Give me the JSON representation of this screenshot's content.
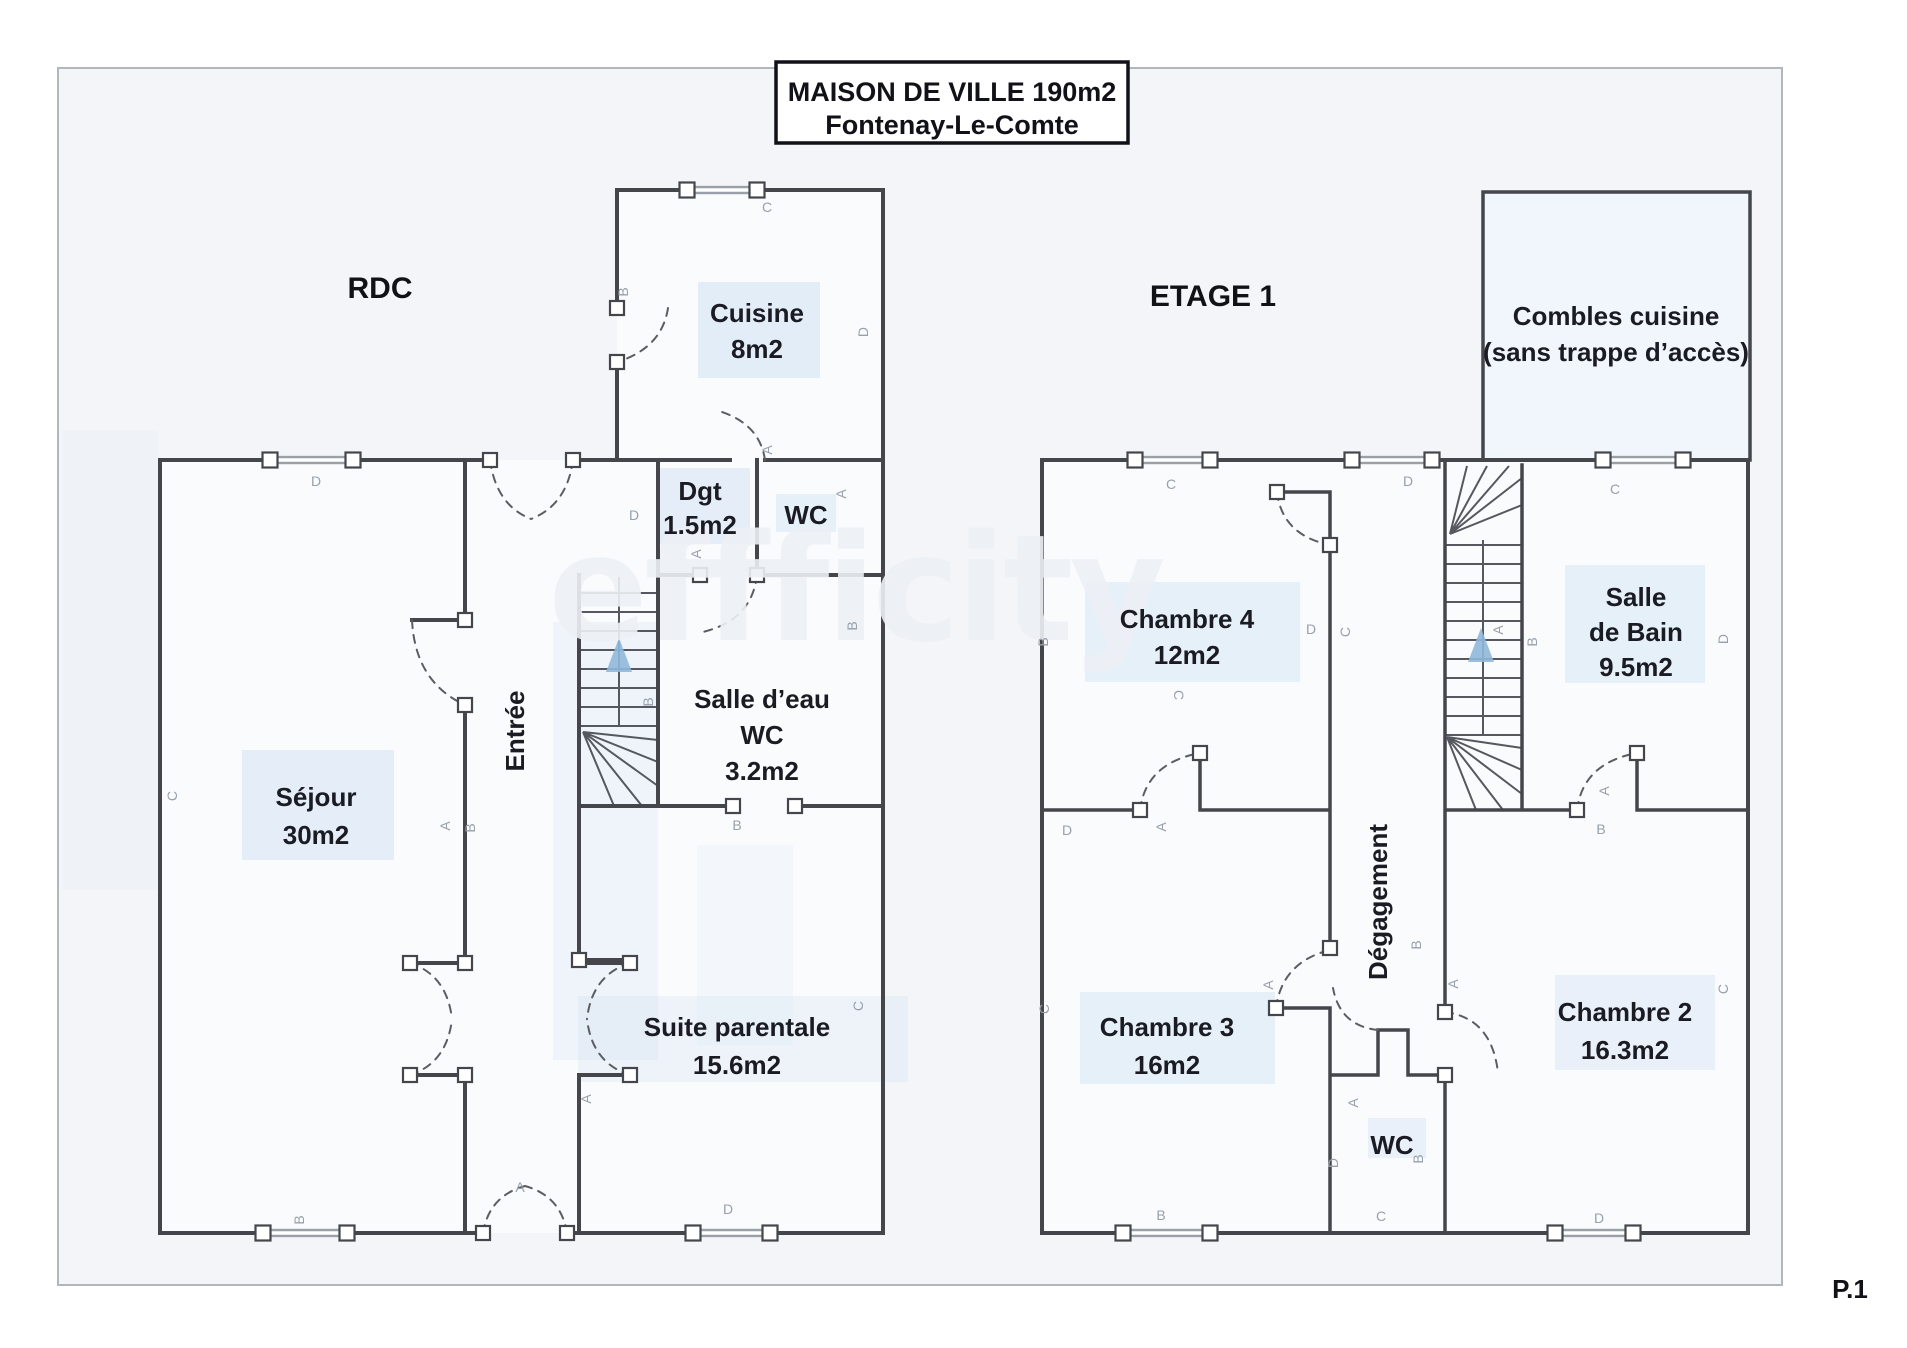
{
  "title": {
    "line1": "MAISON DE VILLE 190m2",
    "line2": "Fontenay-Le-Comte"
  },
  "watermark": "effficity",
  "page": {
    "label": "P.1"
  },
  "floors": [
    {
      "id": "rdc",
      "label": "RDC"
    },
    {
      "id": "etage1",
      "label": "ETAGE 1"
    }
  ],
  "rooms": [
    {
      "id": "cuisine",
      "floor": "rdc",
      "lines": [
        "Cuisine",
        "8m2"
      ],
      "x": 757,
      "y": 322,
      "lh": 36
    },
    {
      "id": "dgt",
      "floor": "rdc",
      "lines": [
        "Dgt",
        "1.5m2"
      ],
      "x": 700,
      "y": 500,
      "lh": 34
    },
    {
      "id": "wc-rdc",
      "floor": "rdc",
      "lines": [
        "WC"
      ],
      "x": 806,
      "y": 524,
      "lh": 34
    },
    {
      "id": "salle-deau",
      "floor": "rdc",
      "lines": [
        "Salle d’eau",
        "WC",
        "3.2m2"
      ],
      "x": 762,
      "y": 708,
      "lh": 36
    },
    {
      "id": "entree",
      "floor": "rdc",
      "lines": [
        "Entrée"
      ],
      "x": 524,
      "y": 731,
      "lh": 0,
      "vertical": true
    },
    {
      "id": "sejour",
      "floor": "rdc",
      "lines": [
        "Séjour",
        "30m2"
      ],
      "x": 316,
      "y": 806,
      "lh": 38
    },
    {
      "id": "suite-parentale",
      "floor": "rdc",
      "lines": [
        "Suite parentale",
        "15.6m2"
      ],
      "x": 737,
      "y": 1036,
      "lh": 38
    },
    {
      "id": "combles",
      "floor": "etage1",
      "lines": [
        "Combles cuisine",
        "(sans trappe d’accès)"
      ],
      "x": 1616,
      "y": 325,
      "lh": 36
    },
    {
      "id": "chambre4",
      "floor": "etage1",
      "lines": [
        "Chambre 4",
        "12m2"
      ],
      "x": 1187,
      "y": 628,
      "lh": 36
    },
    {
      "id": "salle-de-bain",
      "floor": "etage1",
      "lines": [
        "Salle",
        "de Bain",
        "9.5m2"
      ],
      "x": 1636,
      "y": 606,
      "lh": 35
    },
    {
      "id": "degagement",
      "floor": "etage1",
      "lines": [
        "Dégagement"
      ],
      "x": 1387,
      "y": 902,
      "lh": 0,
      "vertical": true
    },
    {
      "id": "chambre3",
      "floor": "etage1",
      "lines": [
        "Chambre 3",
        "16m2"
      ],
      "x": 1167,
      "y": 1036,
      "lh": 38
    },
    {
      "id": "wc-etage1",
      "floor": "etage1",
      "lines": [
        "WC"
      ],
      "x": 1392,
      "y": 1154,
      "lh": 34
    },
    {
      "id": "chambre2",
      "floor": "etage1",
      "lines": [
        "Chambre 2",
        "16.3m2"
      ],
      "x": 1625,
      "y": 1021,
      "lh": 38
    }
  ],
  "wall_letters": [
    {
      "t": "C",
      "x": 767,
      "y": 212,
      "r": 0
    },
    {
      "t": "B",
      "x": 628,
      "y": 292,
      "r": -90
    },
    {
      "t": "D",
      "x": 868,
      "y": 332,
      "r": -90
    },
    {
      "t": "A",
      "x": 772,
      "y": 450,
      "r": -90
    },
    {
      "t": "D",
      "x": 316,
      "y": 486,
      "r": 0
    },
    {
      "t": "D",
      "x": 634,
      "y": 520,
      "r": 0
    },
    {
      "t": "A",
      "x": 846,
      "y": 494,
      "r": -90
    },
    {
      "t": "B",
      "x": 857,
      "y": 626,
      "r": -90
    },
    {
      "t": "B",
      "x": 653,
      "y": 702,
      "r": -90
    },
    {
      "t": "C",
      "x": 177,
      "y": 796,
      "r": -90
    },
    {
      "t": "A",
      "x": 450,
      "y": 826,
      "r": -90
    },
    {
      "t": "B",
      "x": 475,
      "y": 828,
      "r": -90
    },
    {
      "t": "A",
      "x": 701,
      "y": 554,
      "r": -90
    },
    {
      "t": "B",
      "x": 737,
      "y": 830,
      "r": 0
    },
    {
      "t": "A",
      "x": 591,
      "y": 1099,
      "r": -90
    },
    {
      "t": "C",
      "x": 863,
      "y": 1006,
      "r": -90
    },
    {
      "t": "A",
      "x": 520,
      "y": 1192,
      "r": 0
    },
    {
      "t": "B",
      "x": 304,
      "y": 1220,
      "r": -90
    },
    {
      "t": "D",
      "x": 728,
      "y": 1214,
      "r": 0
    },
    {
      "t": "C",
      "x": 1171,
      "y": 489,
      "r": 0
    },
    {
      "t": "D",
      "x": 1408,
      "y": 486,
      "r": 0
    },
    {
      "t": "B",
      "x": 1048,
      "y": 642,
      "r": -90
    },
    {
      "t": "C",
      "x": 1174,
      "y": 695,
      "r": 90
    },
    {
      "t": "D",
      "x": 1311,
      "y": 634,
      "r": 0
    },
    {
      "t": "C",
      "x": 1350,
      "y": 632,
      "r": -90
    },
    {
      "t": "A",
      "x": 1503,
      "y": 630,
      "r": -90
    },
    {
      "t": "B",
      "x": 1537,
      "y": 642,
      "r": -90
    },
    {
      "t": "C",
      "x": 1615,
      "y": 494,
      "r": 0
    },
    {
      "t": "D",
      "x": 1728,
      "y": 639,
      "r": -90
    },
    {
      "t": "D",
      "x": 1067,
      "y": 835,
      "r": 0
    },
    {
      "t": "A",
      "x": 1166,
      "y": 827,
      "r": -90
    },
    {
      "t": "B",
      "x": 1421,
      "y": 945,
      "r": -90
    },
    {
      "t": "A",
      "x": 1273,
      "y": 985,
      "r": -90
    },
    {
      "t": "C",
      "x": 1049,
      "y": 1009,
      "r": -90
    },
    {
      "t": "A",
      "x": 1358,
      "y": 1103,
      "r": -90
    },
    {
      "t": "D",
      "x": 1338,
      "y": 1163,
      "r": -90
    },
    {
      "t": "B",
      "x": 1423,
      "y": 1159,
      "r": -90
    },
    {
      "t": "C",
      "x": 1381,
      "y": 1221,
      "r": 0
    },
    {
      "t": "B",
      "x": 1161,
      "y": 1220,
      "r": 0
    },
    {
      "t": "D",
      "x": 1599,
      "y": 1223,
      "r": 0
    },
    {
      "t": "C",
      "x": 1728,
      "y": 989,
      "r": -90
    },
    {
      "t": "A",
      "x": 1458,
      "y": 984,
      "r": -90
    },
    {
      "t": "B",
      "x": 1601,
      "y": 834,
      "r": 0
    },
    {
      "t": "A",
      "x": 1609,
      "y": 791,
      "r": -90
    }
  ],
  "colors": {
    "wall": "#44464c",
    "label_text": "#1b1b24",
    "letter_gray": "#97a0ab",
    "highlight_blue": "#cfe2f3",
    "stair_arrow_blue": "#8fb8da",
    "paper": "#f3f5f8"
  }
}
